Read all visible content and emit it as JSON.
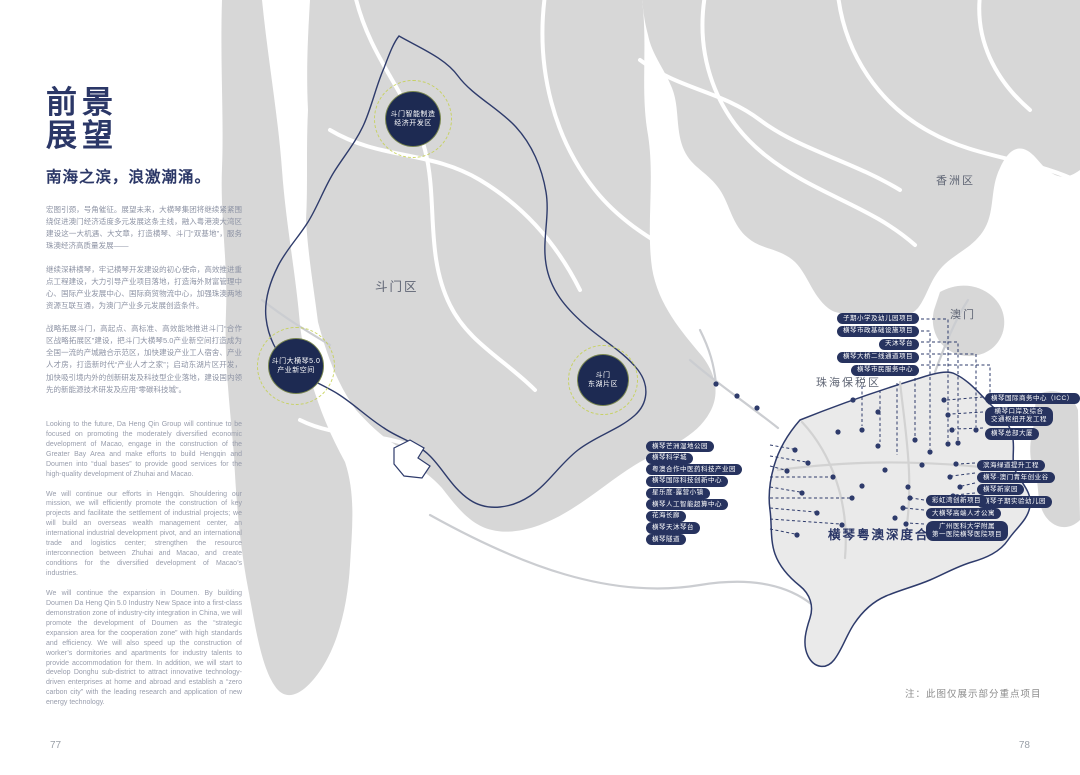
{
  "page": {
    "left_number": "77",
    "right_number": "78",
    "note": "注：此图仅展示部分重点项目"
  },
  "intro": {
    "title_line1": "前景",
    "title_line2": "展望",
    "subtitle": "南海之滨，浪激潮涌。",
    "zh_paragraphs": [
      "宏图引颈，号角催征。展望未来，大横琴集团将继续紧紧围绕促进澳门经济适度多元发展这条主线，融入粤港澳大湾区建设这一大机遇、大文章，打造横琴、斗门“双基地”，服务珠澳经济高质量发展——",
      "继续深耕横琴，牢记横琴开发建设的初心使命，高效推进重点工程建设，大力引导产业项目落地，打造海外财富管理中心、国际产业发展中心、国际商贸物流中心，加强珠澳两地资源互联互通，为澳门产业多元发展创造条件。",
      "战略拓展斗门，高起点、高标准、高效能地推进斗门“合作区战略拓展区”建设，把斗门大横琴5.0产业新空间打造成为全国一流的产城融合示范区，加快建设产业工人宿舍、产业人才房，打造新时代“产业人才之家”；启动东湖片区开发，加快吸引境内外的创新研发及科技型企业落地，建设国内领先的新能源技术研发及应用“零碳科技城”。"
    ],
    "en_paragraphs": [
      "Looking to the future, Da Heng Qin Group will continue to be focused on promoting the moderately diversified economic development of Macao, engage in the construction of the Greater Bay Area and make efforts to build Hengqin and Doumen into “dual bases” to provide good services for the high-quality development of Zhuhai and Macao.",
      "We will continue our efforts in Hengqin. Shouldering our mission, we will efficiently promote the construction of key projects and facilitate the settlement of industrial projects; we will build an overseas wealth management center, an international industrial development pivot, and an international trade and logistics center; strengthen the resource interconnection between Zhuhai and Macao, and create conditions for the diversified development of Macao’s industries.",
      "We will continue the expansion in Doumen. By building Doumen Da Heng Qin 5.0 Industry New Space into a first-class demonstration zone of industry-city integration in China, we will promote the development of Doumen as the “strategic expansion area for the cooperation zone” with high standards and efficiency. We will also speed up the construction of worker’s dormitories and apartments for industry talents to provide accommodation for them. In addition, we will start to develop Donghu sub-district to attract innovative technology-driven enterprises at home and abroad and establish a “zero carbon city” with the leading research and application of new energy technology."
    ]
  },
  "map": {
    "region_labels": {
      "doumen": "斗门区",
      "xiangzhou": "香洲区",
      "macau": "澳门",
      "zhuhai_ftz": "珠海保税区",
      "hengqin_coop": "横琴粤澳深度合作区"
    },
    "markers": [
      {
        "line1": "斗门智能制造",
        "line2": "经济开发区"
      },
      {
        "line1": "斗门大横琴5.0",
        "line2": "产业新空间"
      },
      {
        "line1": "斗门",
        "line2": "东湖片区"
      }
    ],
    "groups": {
      "top": [
        "子期小学及幼儿园项目",
        "横琴市政基础设施项目",
        "天沐琴台",
        "横琴大桥二线通道项目",
        "横琴市民服务中心"
      ],
      "right_upper": [
        "横琴国际商务中心（ICC）",
        "横琴口岸及综合",
        "交通枢纽开发工程",
        "横琴总部大厦"
      ],
      "left": [
        "横琴芒洲湿地公园",
        "横琴科学城",
        "粤澳合作中医药科技产业园",
        "横琴国际科技创新中心",
        "星乐度·露营小镇",
        "横琴人工智能超算中心",
        "花海长廊",
        "横琴天沐琴台",
        "横琴隧道"
      ],
      "right_mid": [
        "滨海绿道提升工程",
        "横琴·澳门青年创业谷",
        "横琴新家园",
        "横琴子期实验幼儿园"
      ],
      "bottom": [
        "彩虹湾创新项目",
        "大横琴高端人才公寓",
        "广州医科大学附属",
        "第一医院横琴医院项目"
      ]
    }
  },
  "colors": {
    "navy": "#27335f",
    "ring_green": "#c5d14f",
    "land_gray": "#d7d7d7"
  }
}
